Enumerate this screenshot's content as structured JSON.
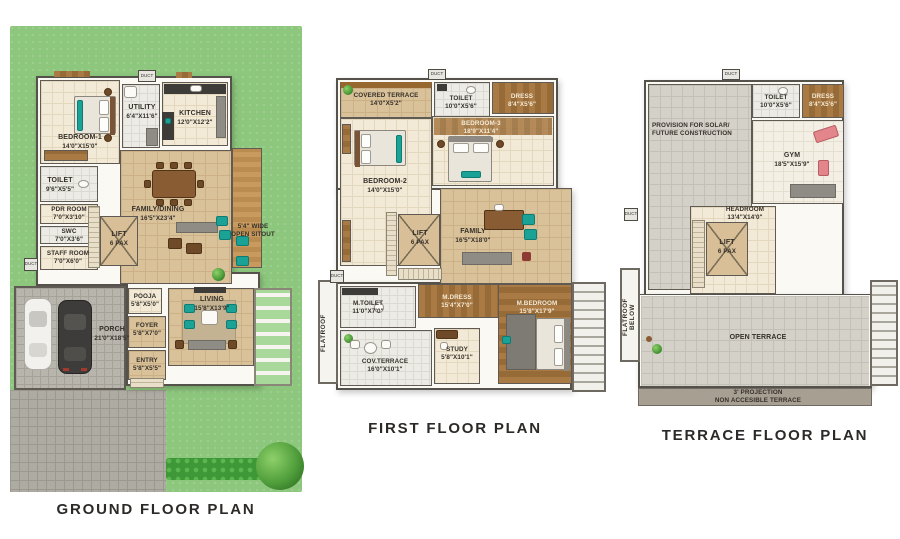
{
  "colors": {
    "lawn": "#8dc77d",
    "accent_teal": "#1aa296",
    "wood": "#a5743f",
    "wall": "#55524c",
    "label_text": "#35302a"
  },
  "titles": {
    "ground": "GROUND FLOOR PLAN",
    "first": "FIRST FLOOR PLAN",
    "terrace": "TERRACE FLOOR PLAN"
  },
  "shared": {
    "duct": "DUCT",
    "lift": {
      "name": "LIFT",
      "dim": "6 PAX"
    }
  },
  "ground": {
    "rooms": {
      "bedroom1": {
        "name": "BEDROOM-1",
        "dim": "14'0\"X15'0\""
      },
      "utility": {
        "name": "UTILITY",
        "dim": "6'4\"X11'6\""
      },
      "kitchen": {
        "name": "KITCHEN",
        "dim": "12'0\"X12'2\""
      },
      "toilet": {
        "name": "TOILET",
        "dim": "9'6\"X5'5\""
      },
      "pdr": {
        "name": "PDR ROOM",
        "dim": "7'0\"X3'10\""
      },
      "swc": {
        "name": "SWC",
        "dim": "7'0\"X3'6\""
      },
      "staff": {
        "name": "STAFF ROOM",
        "dim": "7'0\"X6'0\""
      },
      "familydining": {
        "name": "FAMILY/DINING",
        "dim": "16'5\"X23'4\""
      },
      "sitout": {
        "l1": "5'4\" WIDE",
        "l2": "OPEN SITOUT"
      },
      "pooja": {
        "name": "POOJA",
        "dim": "5'8\"X5'0\""
      },
      "foyer": {
        "name": "FOYER",
        "dim": "5'8\"X7'0\""
      },
      "entry": {
        "name": "ENTRY",
        "dim": "5'8\"X5'5\""
      },
      "living": {
        "name": "LIVING",
        "dim": "15'8\"X13'9\""
      },
      "porch": {
        "name": "PORCH",
        "dim": "21'0\"X18'5\""
      }
    }
  },
  "first": {
    "rooms": {
      "covered_terrace": {
        "name": "COVERED TERRACE",
        "dim": "14'0\"X5'2\""
      },
      "toilet": {
        "name": "TOILET",
        "dim": "10'0\"X5'6\""
      },
      "dress": {
        "name": "DRESS",
        "dim": "8'4\"X5'6\""
      },
      "bedroom3": {
        "name": "BEDROOM-3",
        "dim": "18'9\"X11'4\""
      },
      "bedroom2": {
        "name": "BEDROOM-2",
        "dim": "14'0\"X15'0\""
      },
      "family": {
        "name": "FAMILY",
        "dim": "16'5\"X18'0\""
      },
      "mtoilet": {
        "name": "M.TOILET",
        "dim": "11'0\"X7'0\""
      },
      "mdress": {
        "name": "M.DRESS",
        "dim": "15'4\"X7'0\""
      },
      "mbedroom": {
        "name": "M.BEDROOM",
        "dim": "15'8\"X17'9\""
      },
      "covterrace": {
        "name": "COV.TERRACE",
        "dim": "16'0\"X10'1\""
      },
      "study": {
        "name": "STUDY",
        "dim": "5'8\"X10'1\""
      },
      "flatroof": "FLATROOF"
    }
  },
  "terrace": {
    "rooms": {
      "solar": {
        "l1": "PROVISION FOR SOLAR/",
        "l2": "FUTURE CONSTRUCTION"
      },
      "toilet": {
        "name": "TOILET",
        "dim": "10'0\"X5'6\""
      },
      "dress": {
        "name": "DRESS",
        "dim": "8'4\"X5'6\""
      },
      "gym": {
        "name": "GYM",
        "dim": "18'5\"X15'9\""
      },
      "headroom": {
        "name": "HEADROOM",
        "dim": "13'4\"X14'0\""
      },
      "open_terrace": "OPEN TERRACE",
      "projection": {
        "l1": "3' PROJECTION",
        "l2": "NON ACCESIBLE TERRACE"
      },
      "flatroof_below": "FLATROOF BELOW"
    }
  }
}
